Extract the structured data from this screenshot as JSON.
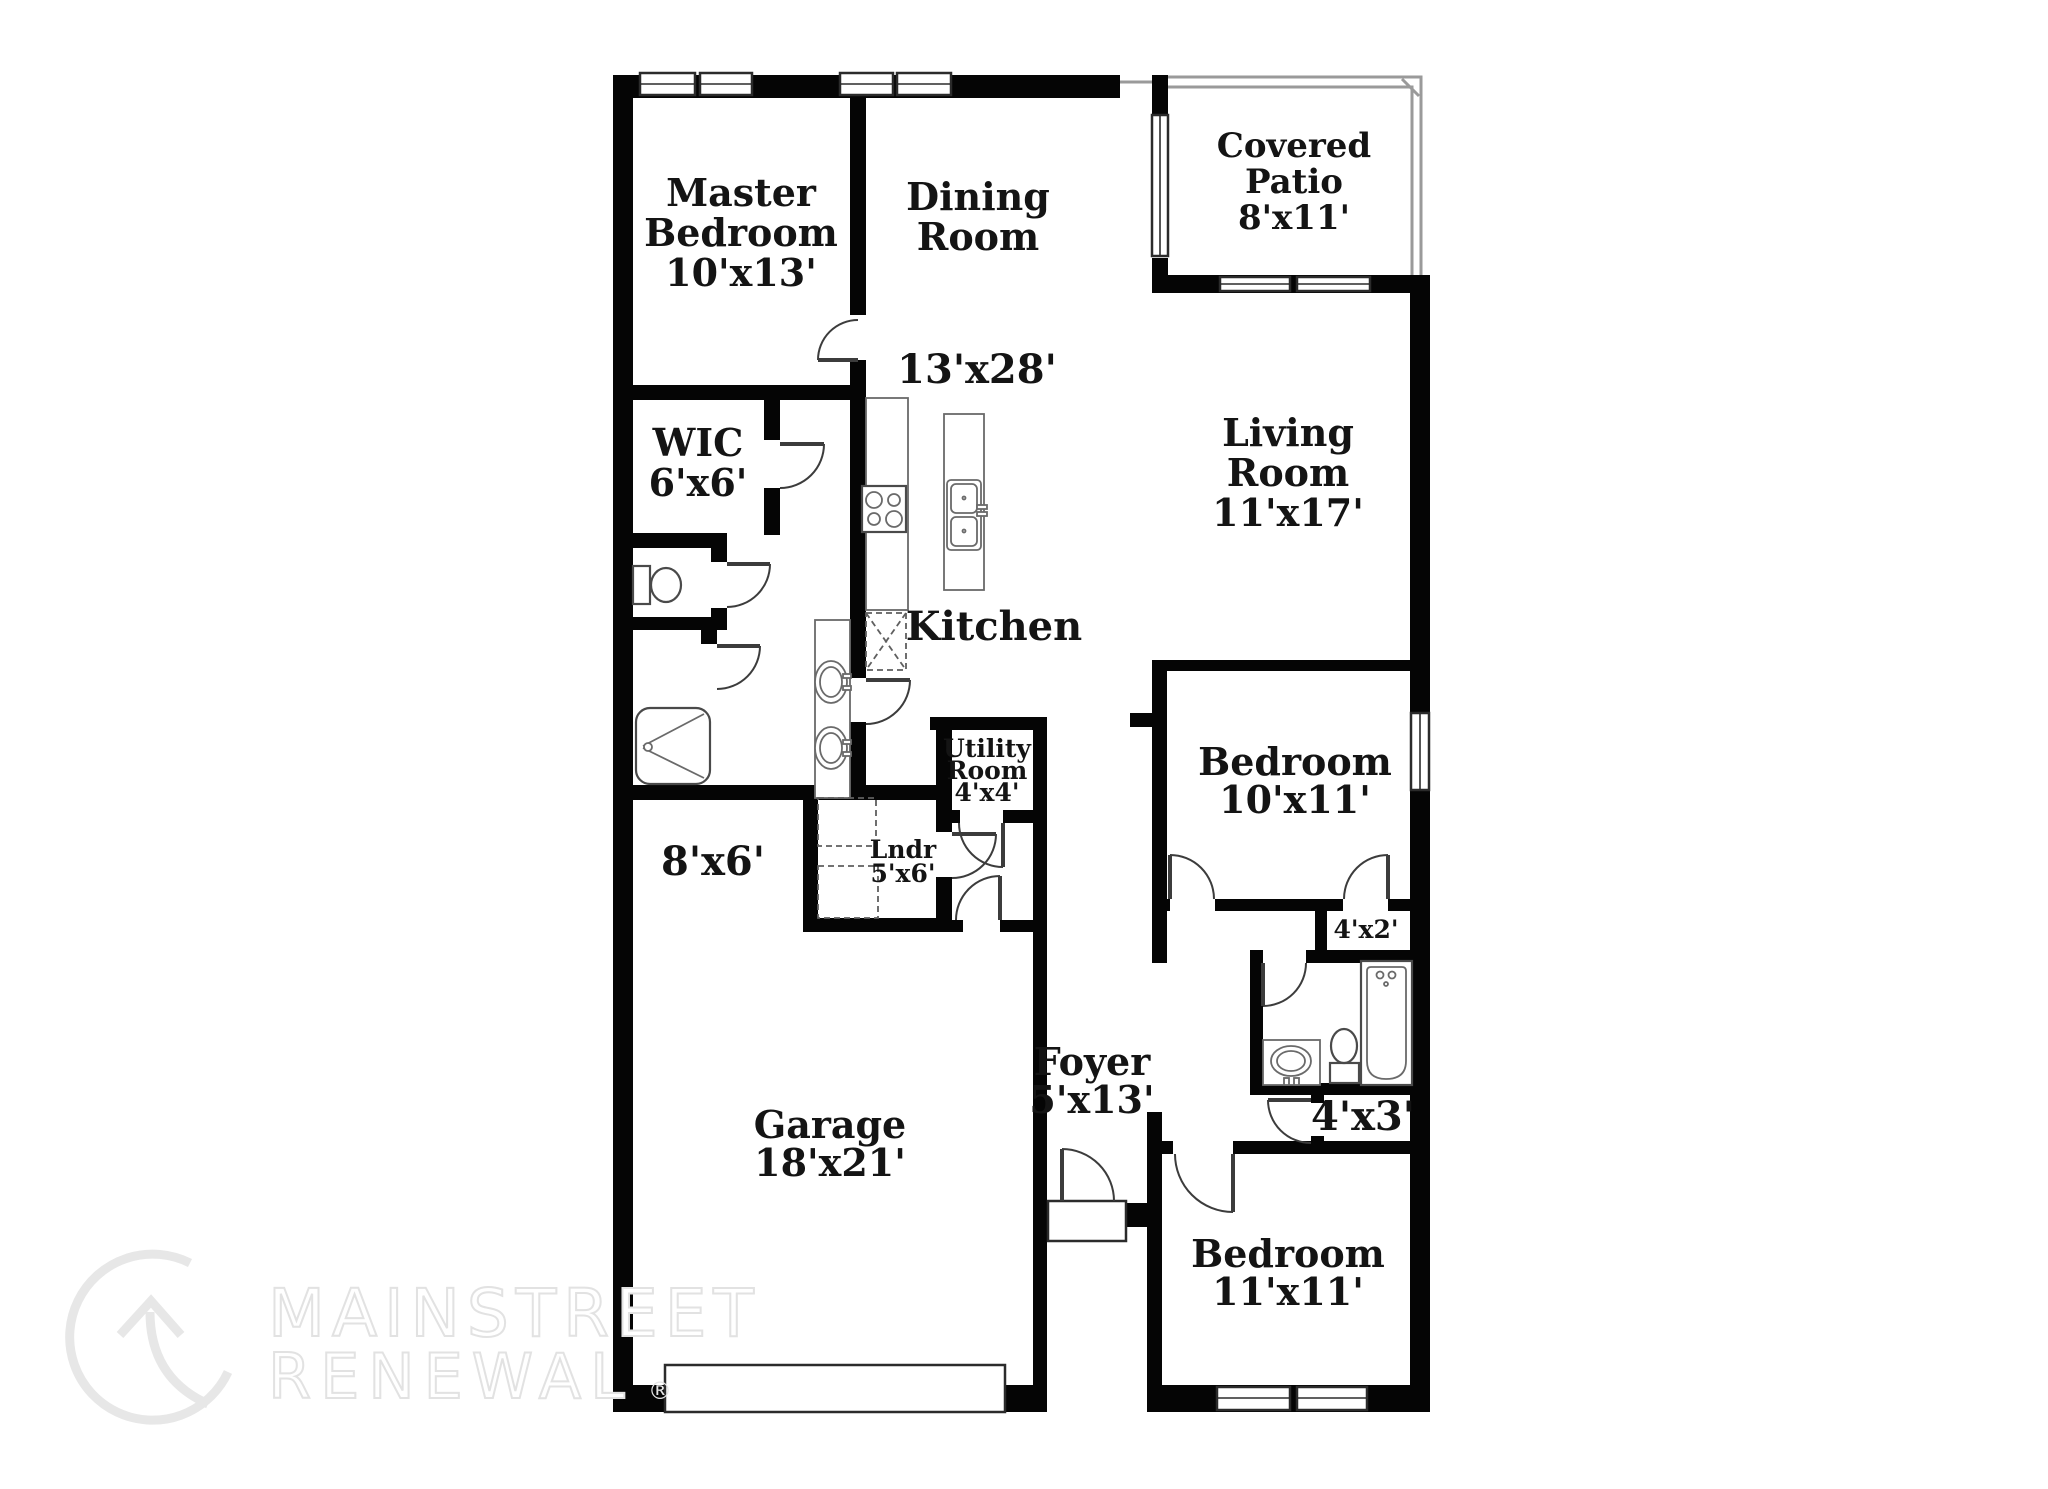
{
  "labels": {
    "master_bedroom": [
      "Master",
      "Bedroom",
      "10'x13'"
    ],
    "dining_room": [
      "Dining",
      "Room"
    ],
    "covered_patio": [
      "Covered",
      "Patio",
      "8'x11'"
    ],
    "great_room_dim": "13'x28'",
    "living_room": [
      "Living",
      "Room",
      "11'x17'"
    ],
    "wic": [
      "WIC",
      "6'x6'"
    ],
    "kitchen": "Kitchen",
    "utility_room": [
      "Utility",
      "Room",
      "4'x4'"
    ],
    "laundry": [
      "Lndr",
      "5'x6'"
    ],
    "garage_storage": "8'x6'",
    "bedroom_2": [
      "Bedroom",
      "10'x11'"
    ],
    "closet_4x2": "4'x2'",
    "foyer": [
      "Foyer",
      "5'x13'"
    ],
    "garage": [
      "Garage",
      "18'x21'"
    ],
    "closet_4x3": "4'x3'",
    "bedroom_3": [
      "Bedroom",
      "11'x11'"
    ]
  },
  "watermark": {
    "brand_line1": "MAINSTREET",
    "brand_line2": "RENEWAL",
    "registered_mark": "®"
  }
}
